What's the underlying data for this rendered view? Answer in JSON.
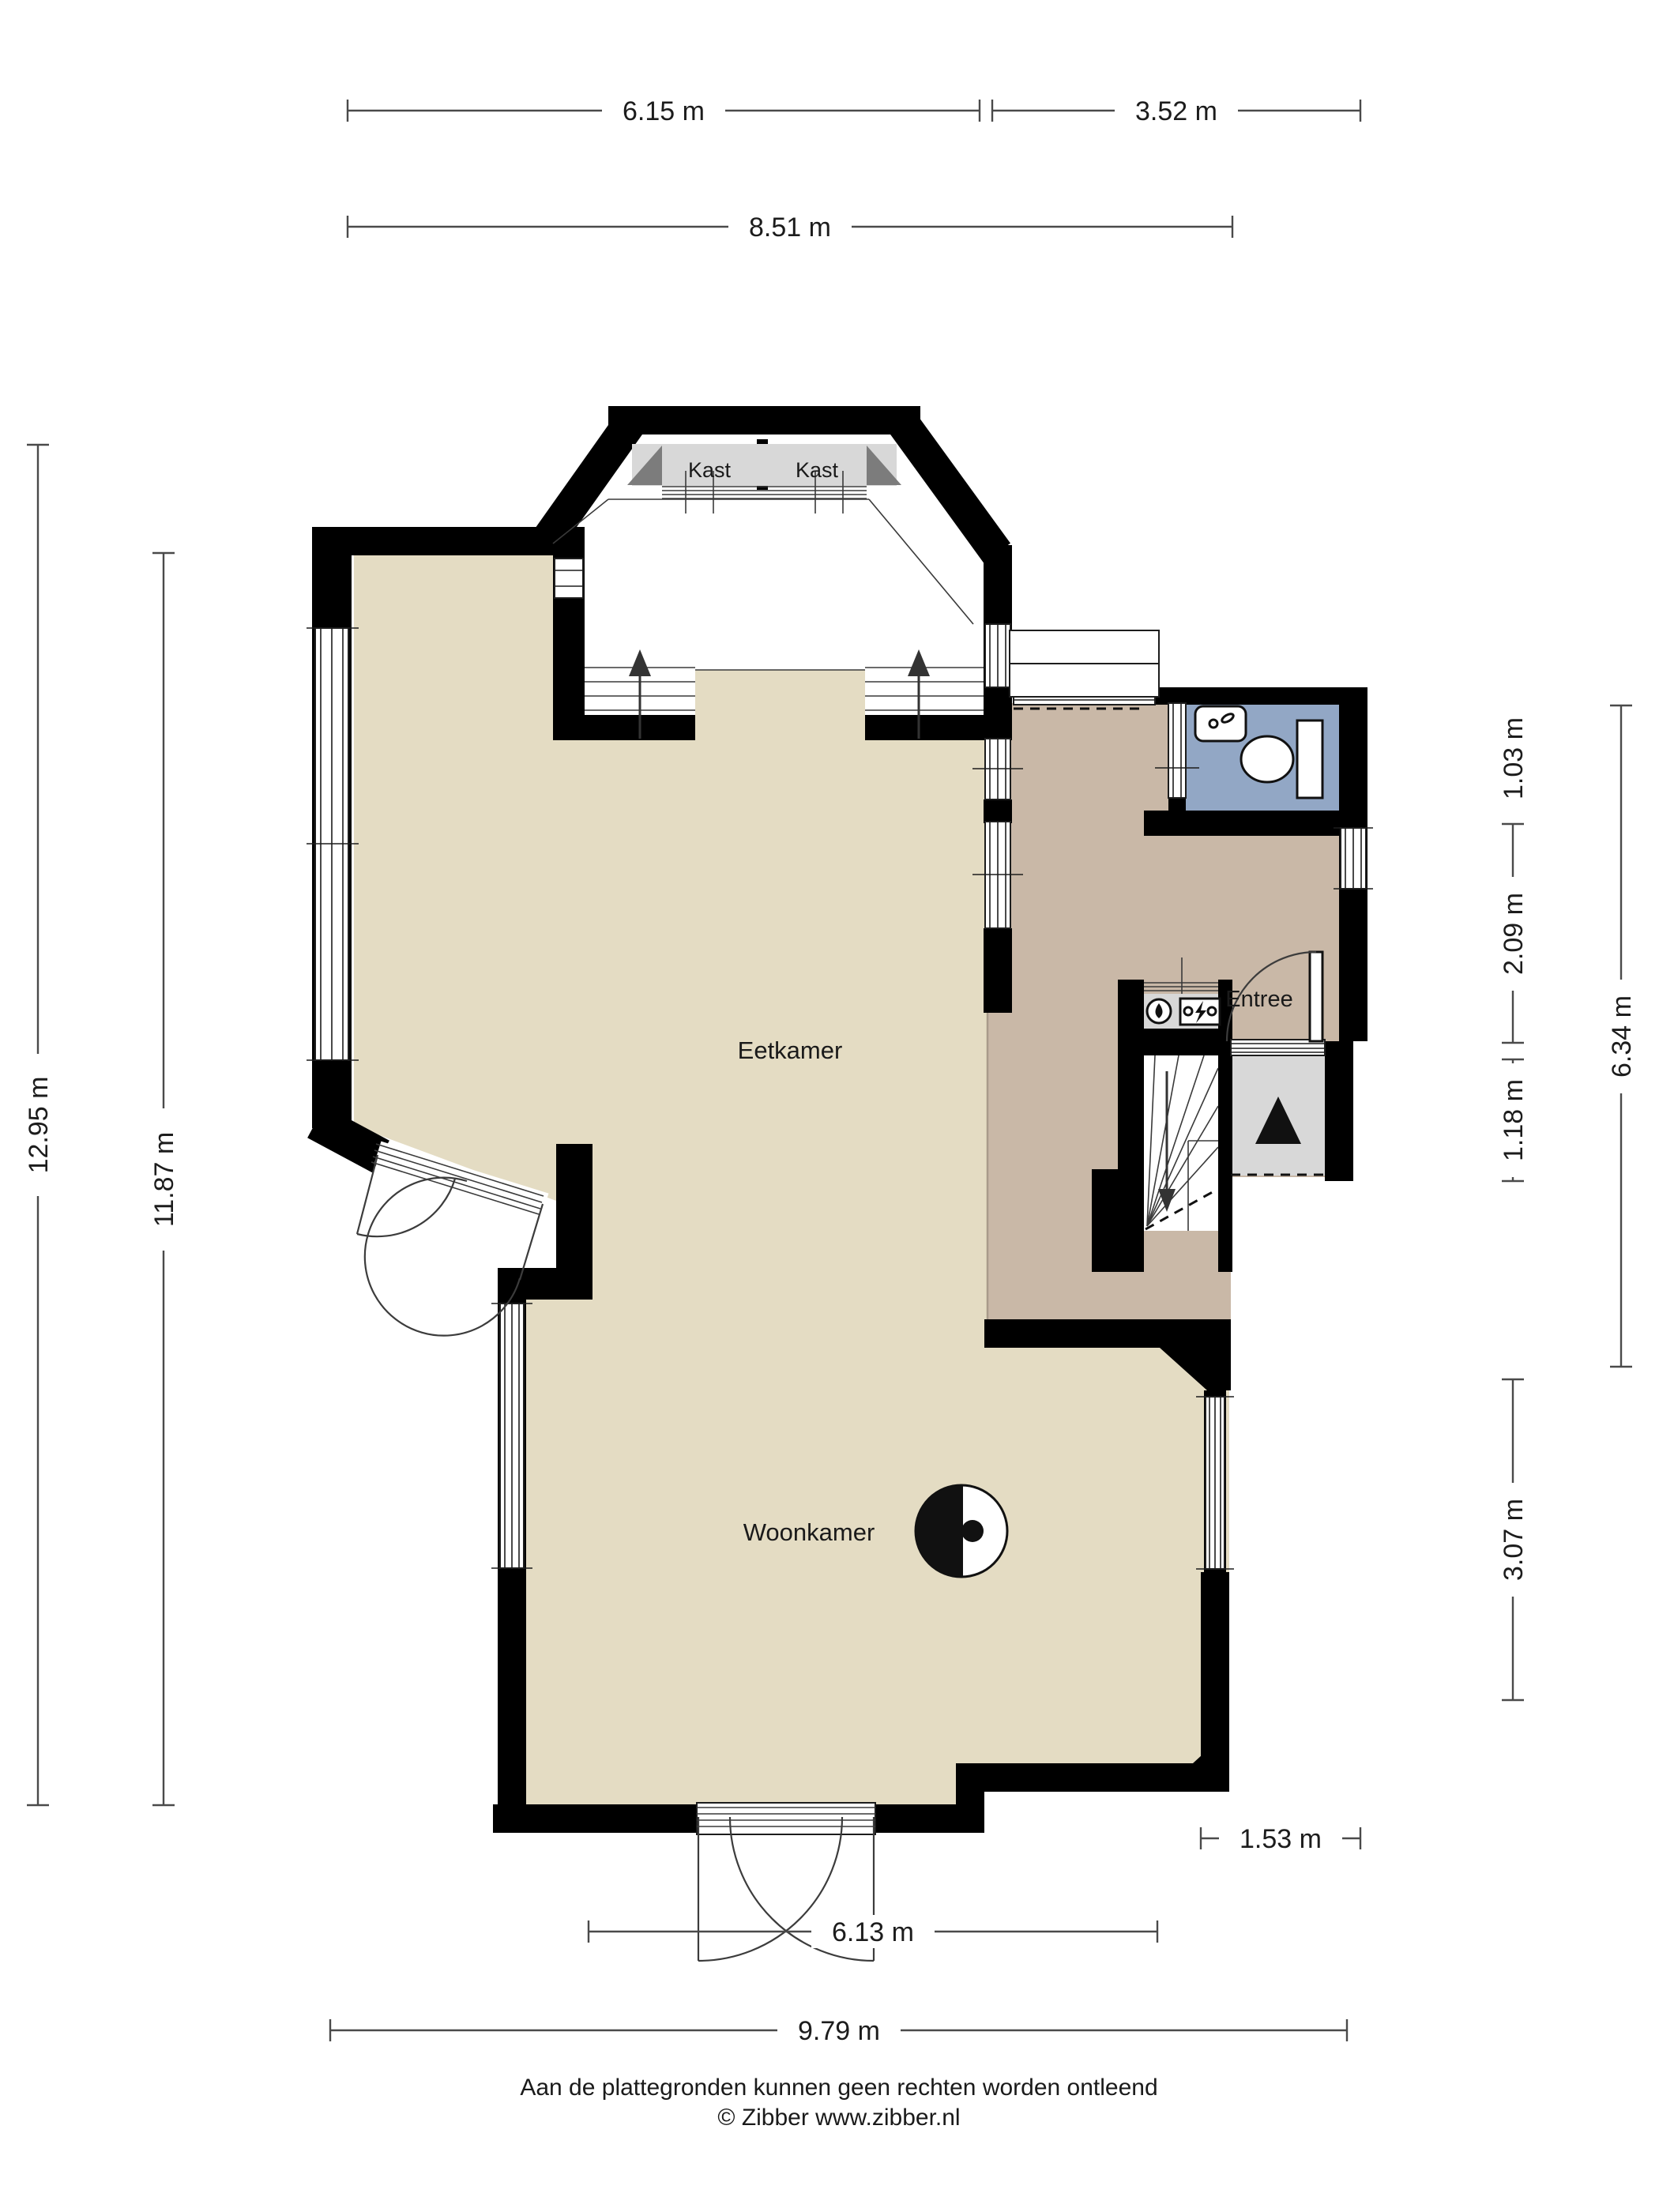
{
  "plan": {
    "rooms": {
      "kast_left": "Kast",
      "kast_right": "Kast",
      "eetkamer": "Eetkamer",
      "entree": "Entree",
      "woonkamer": "Woonkamer"
    },
    "dimensions": {
      "top_left": "6.15 m",
      "top_right": "3.52 m",
      "top_overall": "8.51 m",
      "left_outer": "12.95 m",
      "left_inner": "11.87 m",
      "right_toilet": "1.03 m",
      "right_entree": "2.09 m",
      "right_porch": "1.18 m",
      "right_outer": "6.34 m",
      "right_woonkamer": "3.07 m",
      "bottom_step": "1.53 m",
      "bottom_doors": "6.13 m",
      "bottom_overall": "9.79 m"
    },
    "colors": {
      "floor_beige": "#e4dcc3",
      "floor_tan": "#c9b8a7",
      "floor_blue": "#92a7c5",
      "floor_gray": "#d8d8d8",
      "accent_dark_gray": "#7c7c7c",
      "wall": "#000000",
      "dimension_line": "#4a4a4a"
    }
  },
  "footer": {
    "disclaimer": "Aan de plattegronden kunnen geen rechten worden ontleend",
    "credit": "© Zibber www.zibber.nl"
  }
}
